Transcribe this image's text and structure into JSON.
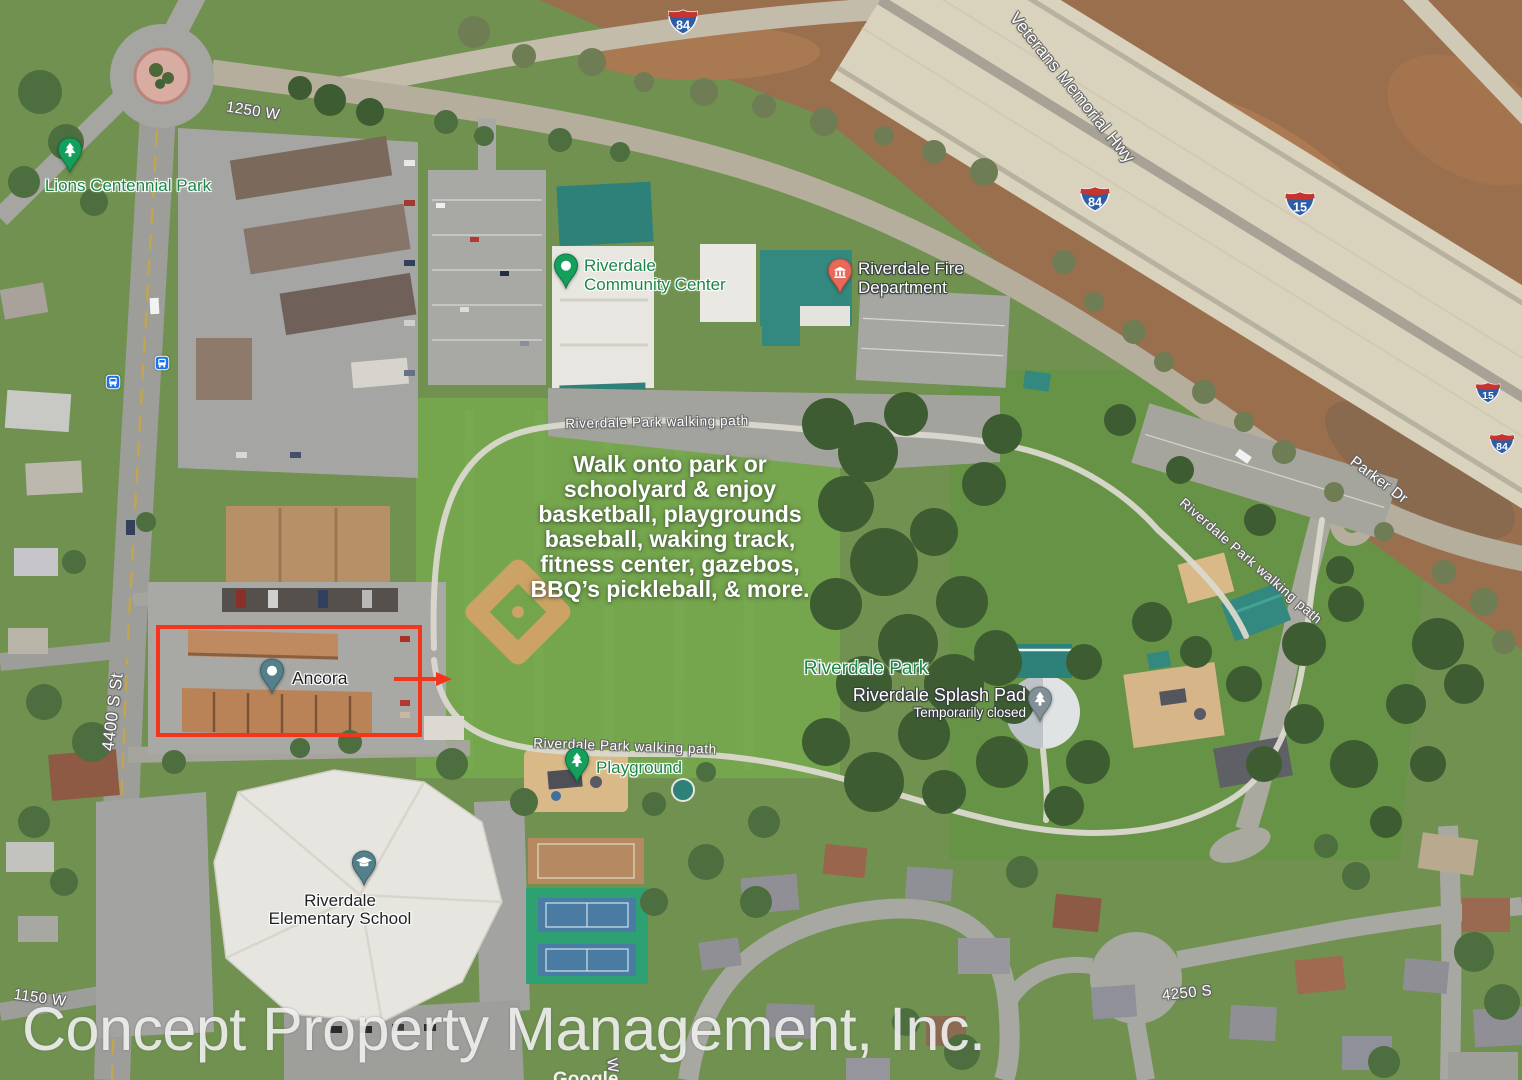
{
  "map_overlay": {
    "watermark": "Concept Property Management, Inc.",
    "google_partial": "Google",
    "highlight_color": "#f5351b",
    "note_lines": [
      "Walk onto park or",
      "schoolyard & enjoy",
      "basketball, playgrounds",
      "baseball, waking track,",
      "fitness center, gazebos,",
      "BBQ’s pickleball, & more."
    ]
  },
  "pois": {
    "lions_park": {
      "label": "Lions Centennial Park",
      "pin_color": "#14a05c"
    },
    "community_center": {
      "line1": "Riverdale",
      "line2": "Community Center",
      "pin_color": "#14a05c"
    },
    "fire_department": {
      "line1": "Riverdale Fire",
      "line2": "Department",
      "pin_color": "#e8685a"
    },
    "riverdale_park": {
      "label": "Riverdale Park"
    },
    "splash_pad": {
      "label": "Riverdale Splash Pad",
      "status": "Temporarily closed",
      "pin_color": "#828f96"
    },
    "ancora": {
      "label": "Ancora",
      "pin_color": "#54808c"
    },
    "playground": {
      "label": "Playground",
      "pin_color": "#14a05c"
    },
    "elementary_school": {
      "line1": "Riverdale",
      "line2": "Elementary School",
      "pin_color": "#54808c"
    }
  },
  "streets": {
    "s_1250w": "1250 W",
    "veterans_hwy": "Veterans Memorial Hwy",
    "parker_dr": "Parker Dr",
    "s_4400": "4400 S St",
    "s_1150w": "1150 W",
    "s_4250": "4250 S",
    "w4_partial": "W 4",
    "walking_path": "Riverdale Park walking path"
  },
  "route_shields": {
    "i84": "84",
    "i15": "15"
  },
  "icons": {
    "park_pin": "tree-icon",
    "generic_pin": "dot-icon",
    "fire_pin": "government-building-icon",
    "school_pin": "graduation-cap-icon",
    "bus": "bus-icon",
    "interstate": "interstate-shield-icon"
  }
}
